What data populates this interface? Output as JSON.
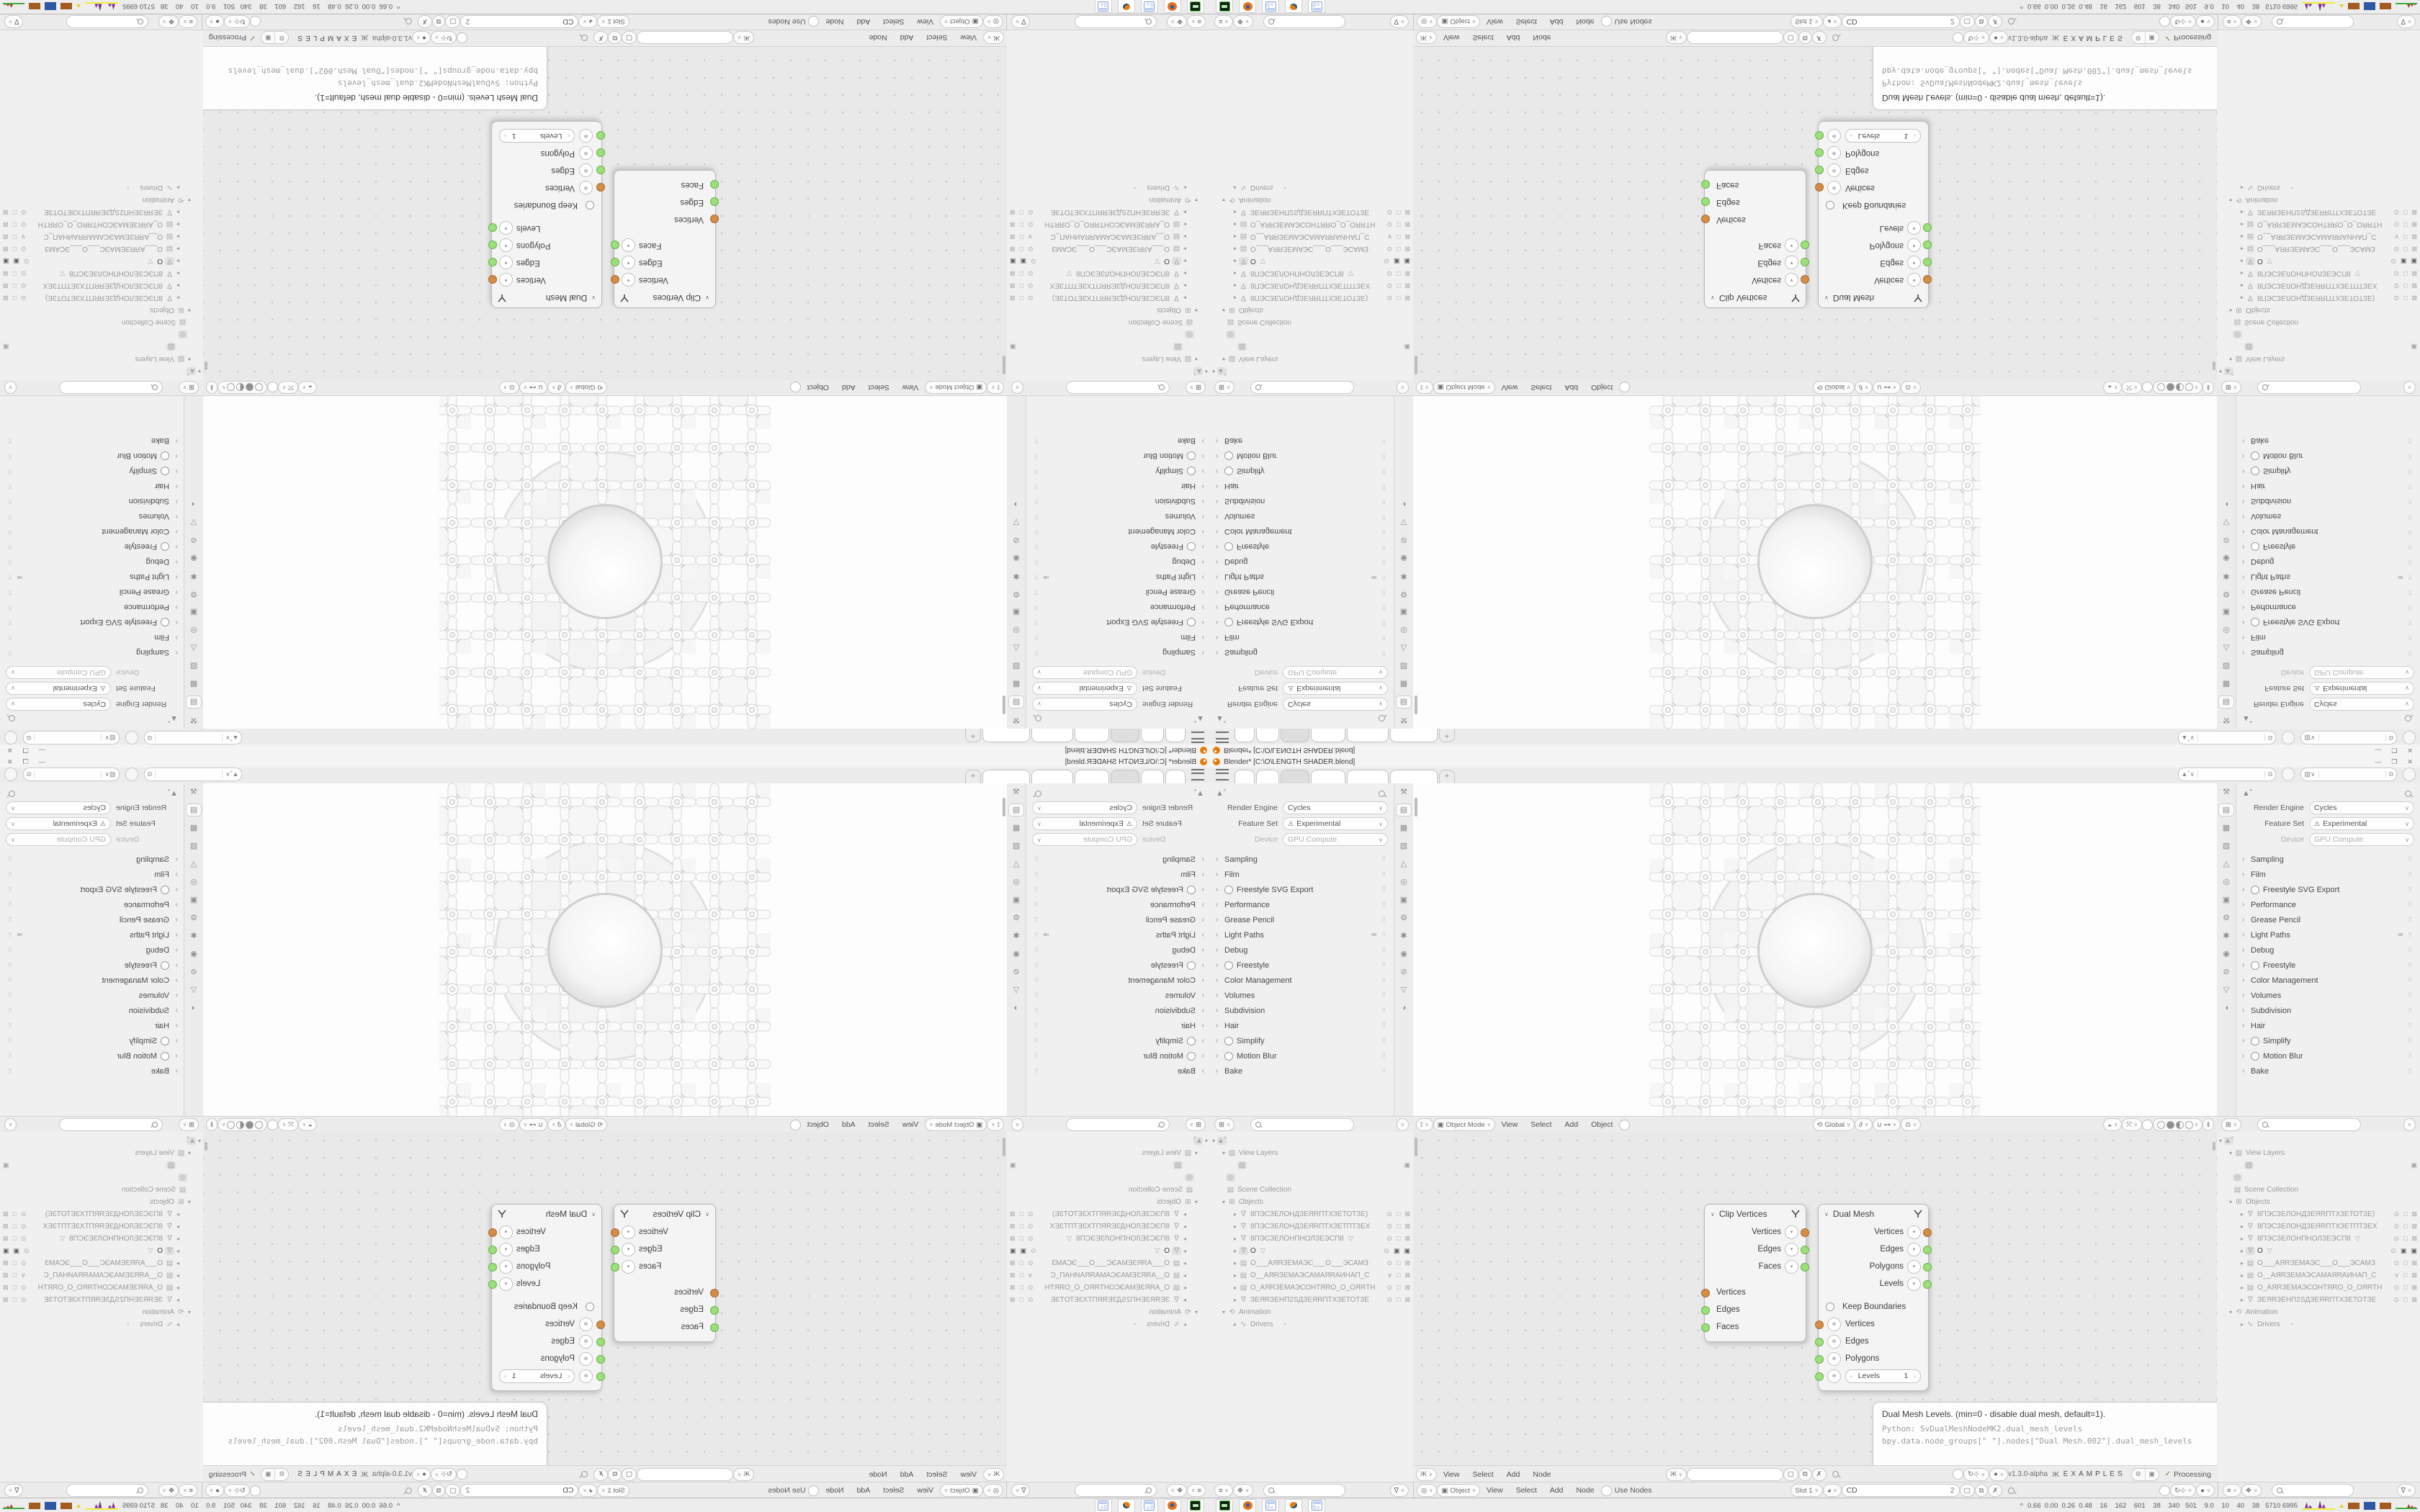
{
  "titlebar": {
    "title": "Blender* [C:\\O\\LENGTH SHADER.blend]",
    "minimize": "—",
    "maximize": "❒",
    "close": "✕"
  },
  "topbar": {
    "tabs": [
      "",
      "",
      "",
      "",
      "",
      ""
    ],
    "new_tab": "+"
  },
  "props": {
    "rows": [
      {
        "label": "Render Engine",
        "value": "Cycles"
      },
      {
        "label": "Feature Set",
        "value": "Experimental"
      },
      {
        "label": "Device",
        "value": "GPU Compute"
      }
    ],
    "sections": [
      "Sampling",
      "Film",
      "Freestyle SVG Export",
      "Performance",
      "Grease Pencil",
      "Light Paths",
      "Debug",
      "Freestyle",
      "Color Management",
      "Volumes",
      "Subdivision",
      "Hair",
      "Simplify",
      "Motion Blur",
      "Bake"
    ]
  },
  "viewport": {
    "mode": "Object Mode",
    "menus": [
      "View",
      "Select",
      "Add",
      "Object"
    ],
    "orientation": "Global"
  },
  "outliner": {
    "view_layers": "View Layers",
    "scene_collection": "Scene Collection",
    "objects_label": "Objects",
    "animation": "Animation",
    "drivers": "Drivers",
    "items": [
      "8ПЭСЗЕЛОНДЗЕЯRПТХЗЕТОТЗЕ)",
      "8ПЭСЗЕЛОНДЗЕЯRПТХЗЕТПТЗЕХ",
      "8ПЭСЗЕЛОНПНОЛЗЕЭСП8",
      "O",
      "О___АЯRЗЕМАЭС___О___ЭСАМЗ",
      "О__АЯRЗЕМАЭСАМАЯRАИНАП_С",
      "О_АЯRЗЕМАЭСОНТЯRО_О_ОЯRТН",
      "ЗЕЯRЗЕНП2SДЗЕЯRПТХЗЕТОТЗЕ"
    ]
  },
  "nodes": {
    "clip": {
      "title": "Clip Vertices",
      "out": [
        "Vertices",
        "Edges",
        "Faces"
      ],
      "in": [
        "Vertices",
        "Edges",
        "Faces"
      ]
    },
    "dual": {
      "title": "Dual Mesh",
      "out": [
        "Vertices",
        "Edges",
        "Polygons",
        "Levels"
      ],
      "keep": "Keep Boundaries",
      "in": [
        "Vertices",
        "Edges",
        "Polygons"
      ],
      "levels_label": "Levels",
      "levels_value": "1"
    }
  },
  "tooltip": {
    "l1": "Dual Mesh Levels. (min=0 - disable dual mesh, default=1).",
    "l2": "Python: SvDualMeshNodeMK2.dual_mesh_levels",
    "l3": "bpy.data.node_groups[\" \"].nodes[\"Dual Mesh.002\"].dual_mesh_levels"
  },
  "node_header": {
    "menus": [
      "View",
      "Select",
      "Add",
      "Node"
    ],
    "version": "v1.3.0-alpha",
    "examples": "EXAMPLES",
    "processing": "Processing"
  },
  "shader_header": {
    "type": "Object",
    "menus": [
      "View",
      "Select",
      "Add",
      "Node"
    ],
    "use_nodes": "Use Nodes",
    "slot": "Slot 1",
    "material_name": "CD",
    "material_count": "2"
  },
  "taskbar": {
    "stats": "0.66  0.00  0.26  0.48    16    162    601    38    340   501    9.0    10    40    38   5710 6995",
    "expander": "^"
  },
  "colors": {
    "accent_orange": "#e87d0d",
    "socket_orange": "#d38d47",
    "socket_green": "#9be07a",
    "hist_purple": "#7b2d8e",
    "hist_yellow": "#f0ec37",
    "hist_brown": "#a35b20",
    "hist_blue": "#2e57a5",
    "hist_green": "#3faa3f"
  }
}
